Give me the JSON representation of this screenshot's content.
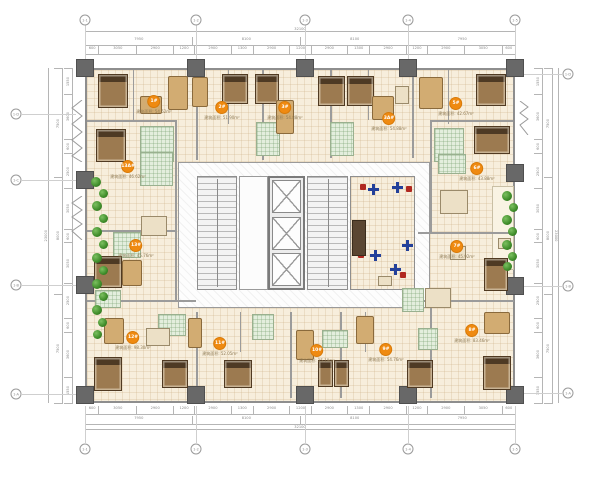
{
  "meta": {
    "drawing_type": "residential tower floor plan",
    "accent_color": "#ef8a11",
    "wall_color": "#8e8e8e",
    "column_color": "#686868",
    "floor_tile_color": "#f7eedc",
    "bathroom_color": "#e3eedd",
    "plant_color": "#3c8a28",
    "bed_color": "#9c7a50"
  },
  "units": [
    {
      "label": "1#",
      "area": "建筑面积: 54.62m²",
      "x": 154,
      "y": 105
    },
    {
      "label": "2#",
      "area": "建筑面积: 51.90m²",
      "x": 222,
      "y": 111
    },
    {
      "label": "3#",
      "area": "建筑面积: 54.88m²",
      "x": 285,
      "y": 111
    },
    {
      "label": "3A#",
      "area": "建筑面积: 54.88m²",
      "x": 389,
      "y": 122
    },
    {
      "label": "5#",
      "area": "建筑面积: 42.67m²",
      "x": 456,
      "y": 107
    },
    {
      "label": "6#",
      "area": "建筑面积: 43.88m²",
      "x": 477,
      "y": 172
    },
    {
      "label": "7#",
      "area": "建筑面积: 45.92m²",
      "x": 457,
      "y": 250
    },
    {
      "label": "8#",
      "area": "建筑面积: 83.46m²",
      "x": 472,
      "y": 334
    },
    {
      "label": "9#",
      "area": "建筑面积: 54.76m²",
      "x": 386,
      "y": 353
    },
    {
      "label": "10#",
      "area": "建筑面积: 35.19m²",
      "x": 317,
      "y": 354
    },
    {
      "label": "11#",
      "area": "建筑面积: 52.05m²",
      "x": 220,
      "y": 347
    },
    {
      "label": "12#",
      "area": "建筑面积: 98.30m²",
      "x": 133,
      "y": 341
    },
    {
      "label": "13#",
      "area": "建筑面积: 45.76m²",
      "x": 136,
      "y": 249
    },
    {
      "label": "13A#",
      "area": "建筑面积: 46.62m²",
      "x": 128,
      "y": 170
    }
  ],
  "grid": {
    "top": [
      {
        "label": "1-1",
        "x": 85
      },
      {
        "label": "1-2",
        "x": 196
      },
      {
        "label": "1-3",
        "x": 305
      },
      {
        "label": "1-4",
        "x": 408
      },
      {
        "label": "1-5",
        "x": 515
      }
    ],
    "bottom": [
      {
        "label": "1-1",
        "x": 85
      },
      {
        "label": "1-2",
        "x": 196
      },
      {
        "label": "1-3",
        "x": 305
      },
      {
        "label": "1-4",
        "x": 408
      },
      {
        "label": "1-5",
        "x": 515
      }
    ],
    "left": [
      {
        "label": "1-D",
        "y": 114
      },
      {
        "label": "1-C",
        "y": 180
      },
      {
        "label": "1-B",
        "y": 285
      },
      {
        "label": "1-A",
        "y": 394
      }
    ],
    "right": [
      {
        "label": "1-D",
        "y": 74
      },
      {
        "label": "1-B",
        "y": 286
      },
      {
        "label": "1-A",
        "y": 393
      }
    ]
  },
  "dims": {
    "top_total": "32100",
    "bottom_total": "32100",
    "side_total": "23000",
    "large": [
      {
        "v": "7950"
      },
      {
        "v": "8100"
      },
      {
        "v": "8100"
      },
      {
        "v": "7950"
      }
    ],
    "small": [
      {
        "v": "600"
      },
      {
        "v": "3050"
      },
      {
        "v": "2900"
      },
      {
        "v": "1200"
      },
      {
        "v": "2900"
      },
      {
        "v": "1300"
      },
      {
        "v": "2900"
      },
      {
        "v": "1200"
      },
      {
        "v": "2900"
      },
      {
        "v": "1300"
      },
      {
        "v": "2900"
      },
      {
        "v": "1200"
      },
      {
        "v": "2900"
      },
      {
        "v": "3050"
      },
      {
        "v": "600"
      }
    ],
    "side_large": [
      {
        "v": "7500"
      },
      {
        "v": "8000"
      },
      {
        "v": "7500"
      }
    ],
    "side_small": [
      {
        "v": "1550"
      },
      {
        "v": "3600"
      },
      {
        "v": "600"
      },
      {
        "v": "2500"
      },
      {
        "v": "3050"
      },
      {
        "v": "600"
      },
      {
        "v": "3050"
      },
      {
        "v": "2500"
      },
      {
        "v": "600"
      },
      {
        "v": "3600"
      },
      {
        "v": "1550"
      }
    ]
  },
  "core": {
    "stairs": 2,
    "elevators": 3,
    "office_room": true
  }
}
